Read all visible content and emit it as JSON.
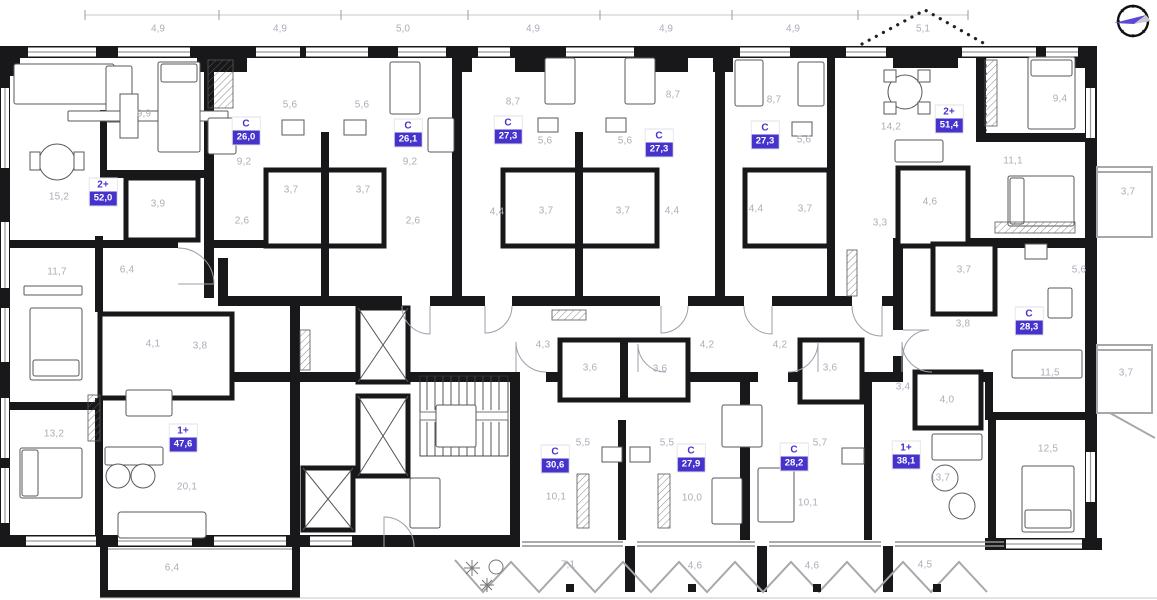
{
  "plan_title": "Residential floor plan",
  "colors": {
    "accent": "#4533cb",
    "wall": "#18181b",
    "room_label": "#a9aeb9",
    "balcony": "#a8a8a8"
  },
  "compass": {
    "icon": "compass-north-arrow"
  },
  "dimensions_top": [
    {
      "label": "4,9",
      "x": 158
    },
    {
      "label": "4,9",
      "x": 280
    },
    {
      "label": "5,0",
      "x": 403
    },
    {
      "label": "4,9",
      "x": 533
    },
    {
      "label": "4,9",
      "x": 666
    },
    {
      "label": "4,9",
      "x": 793
    },
    {
      "label": "5,1",
      "x": 923
    }
  ],
  "apartments": [
    {
      "type": "С",
      "area": "26,0",
      "x": 246,
      "y": 131
    },
    {
      "type": "С",
      "area": "26,1",
      "x": 408,
      "y": 133
    },
    {
      "type": "С",
      "area": "27,3",
      "x": 508,
      "y": 130
    },
    {
      "type": "С",
      "area": "27,3",
      "x": 659,
      "y": 143
    },
    {
      "type": "С",
      "area": "27,3",
      "x": 765,
      "y": 135
    },
    {
      "type": "2+",
      "area": "51,4",
      "x": 949,
      "y": 119
    },
    {
      "type": "2+",
      "area": "52,0",
      "x": 103,
      "y": 192
    },
    {
      "type": "С",
      "area": "28,3",
      "x": 1029,
      "y": 321
    },
    {
      "type": "1+",
      "area": "47,6",
      "x": 183,
      "y": 438
    },
    {
      "type": "С",
      "area": "30,6",
      "x": 555,
      "y": 459
    },
    {
      "type": "С",
      "area": "27,9",
      "x": 691,
      "y": 458
    },
    {
      "type": "С",
      "area": "28,2",
      "x": 794,
      "y": 457
    },
    {
      "type": "1+",
      "area": "38,1",
      "x": 906,
      "y": 455
    }
  ],
  "room_areas": [
    {
      "label": "9,9",
      "x": 144,
      "y": 114
    },
    {
      "label": "5,6",
      "x": 290,
      "y": 105
    },
    {
      "label": "5,6",
      "x": 362,
      "y": 105
    },
    {
      "label": "9,2",
      "x": 244,
      "y": 162
    },
    {
      "label": "15,2",
      "x": 59,
      "y": 197
    },
    {
      "label": "8,7",
      "x": 513,
      "y": 102
    },
    {
      "label": "8,7",
      "x": 673,
      "y": 95
    },
    {
      "label": "8,7",
      "x": 774,
      "y": 100
    },
    {
      "label": "5,6",
      "x": 545,
      "y": 141
    },
    {
      "label": "5,6",
      "x": 625,
      "y": 141
    },
    {
      "label": "9,2",
      "x": 410,
      "y": 162
    },
    {
      "label": "5,6",
      "x": 804,
      "y": 140
    },
    {
      "label": "14,2",
      "x": 891,
      "y": 127
    },
    {
      "label": "9,4",
      "x": 1060,
      "y": 99
    },
    {
      "label": "11,1",
      "x": 1013,
      "y": 161
    },
    {
      "label": "3,7",
      "x": 1128,
      "y": 192
    },
    {
      "label": "3,9",
      "x": 158,
      "y": 204
    },
    {
      "label": "3,7",
      "x": 291,
      "y": 190
    },
    {
      "label": "3,7",
      "x": 363,
      "y": 190
    },
    {
      "label": "2,6",
      "x": 242,
      "y": 221
    },
    {
      "label": "2,6",
      "x": 413,
      "y": 221
    },
    {
      "label": "4,4",
      "x": 497,
      "y": 212
    },
    {
      "label": "3,7",
      "x": 546,
      "y": 211
    },
    {
      "label": "3,7",
      "x": 623,
      "y": 211
    },
    {
      "label": "4,4",
      "x": 672,
      "y": 211
    },
    {
      "label": "4,4",
      "x": 756,
      "y": 209
    },
    {
      "label": "3,7",
      "x": 805,
      "y": 209
    },
    {
      "label": "3,3",
      "x": 880,
      "y": 223
    },
    {
      "label": "4,6",
      "x": 930,
      "y": 202
    },
    {
      "label": "11,7",
      "x": 57,
      "y": 272
    },
    {
      "label": "6,4",
      "x": 127,
      "y": 270
    },
    {
      "label": "3,7",
      "x": 964,
      "y": 270
    },
    {
      "label": "5,6",
      "x": 1079,
      "y": 270
    },
    {
      "label": "3,8",
      "x": 963,
      "y": 324
    },
    {
      "label": "4,1",
      "x": 153,
      "y": 344
    },
    {
      "label": "3,8",
      "x": 200,
      "y": 346
    },
    {
      "label": "4,3",
      "x": 543,
      "y": 345
    },
    {
      "label": "3,6",
      "x": 590,
      "y": 368
    },
    {
      "label": "3,6",
      "x": 660,
      "y": 369
    },
    {
      "label": "4,2",
      "x": 707,
      "y": 345
    },
    {
      "label": "4,2",
      "x": 780,
      "y": 345
    },
    {
      "label": "3,6",
      "x": 830,
      "y": 368
    },
    {
      "label": "3,4",
      "x": 903,
      "y": 387
    },
    {
      "label": "11,5",
      "x": 1050,
      "y": 373
    },
    {
      "label": "3,7",
      "x": 1126,
      "y": 373
    },
    {
      "label": "13,2",
      "x": 54,
      "y": 434
    },
    {
      "label": "20,1",
      "x": 187,
      "y": 487
    },
    {
      "label": "5,5",
      "x": 583,
      "y": 443
    },
    {
      "label": "5,5",
      "x": 667,
      "y": 443
    },
    {
      "label": "5,7",
      "x": 820,
      "y": 443
    },
    {
      "label": "10,1",
      "x": 556,
      "y": 497
    },
    {
      "label": "10,0",
      "x": 692,
      "y": 498
    },
    {
      "label": "10,1",
      "x": 808,
      "y": 503
    },
    {
      "label": "4,0",
      "x": 947,
      "y": 400
    },
    {
      "label": "13,7",
      "x": 940,
      "y": 478
    },
    {
      "label": "12,5",
      "x": 1048,
      "y": 449
    },
    {
      "label": "6,4",
      "x": 172,
      "y": 568
    },
    {
      "label": "7,1",
      "x": 568,
      "y": 565
    },
    {
      "label": "4,6",
      "x": 695,
      "y": 566
    },
    {
      "label": "4,6",
      "x": 812,
      "y": 566
    },
    {
      "label": "4,5",
      "x": 925,
      "y": 565
    }
  ]
}
